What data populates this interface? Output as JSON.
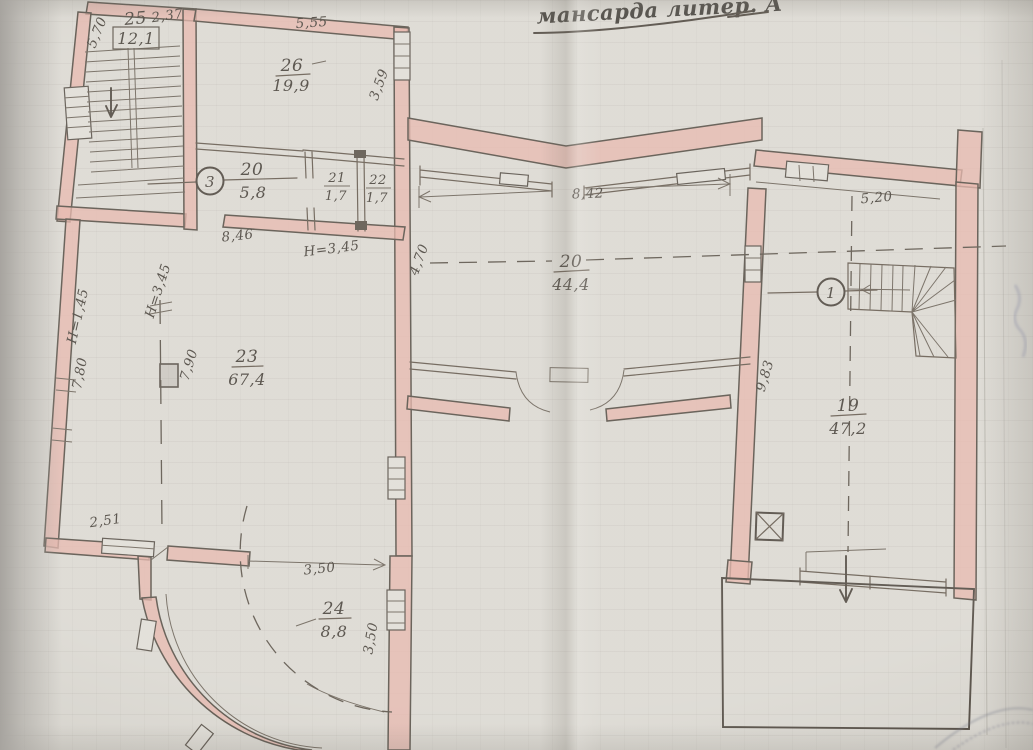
{
  "title": "мансарда литер. А",
  "rooms": {
    "r25": {
      "number": "25",
      "area": "12,1"
    },
    "r26": {
      "number": "26",
      "area": "19,9"
    },
    "r20s": {
      "number": "20",
      "area": "5,8"
    },
    "r21": {
      "number": "21",
      "area": "1,7"
    },
    "r22": {
      "number": "22",
      "area": "1,7"
    },
    "r23": {
      "number": "23",
      "area": "67,4"
    },
    "r20": {
      "number": "20",
      "area": "44,4"
    },
    "r19": {
      "number": "19",
      "area": "47,2"
    },
    "r24": {
      "number": "24",
      "area": "8,8"
    }
  },
  "dimensions": {
    "d570": "5,70",
    "d237": "2,37",
    "d555": "5,55",
    "d359": "3,59",
    "d846": "8,46",
    "h345a": "Н=3,45",
    "h345b": "Н=3,45",
    "h145": "Н=1,45",
    "d780": "7,80",
    "d790": "7,90",
    "d842": "8,42",
    "d470": "4,70",
    "d520": "5,20",
    "d983": "9,83",
    "d251": "2,51",
    "d350a": "3,50",
    "d350b": "3,50"
  },
  "markers": {
    "section1": "1",
    "section3": "3"
  },
  "colors": {
    "wall_highlight": "#e3a99d",
    "paper": "#d7d4cd",
    "ink": "#3c342b"
  }
}
